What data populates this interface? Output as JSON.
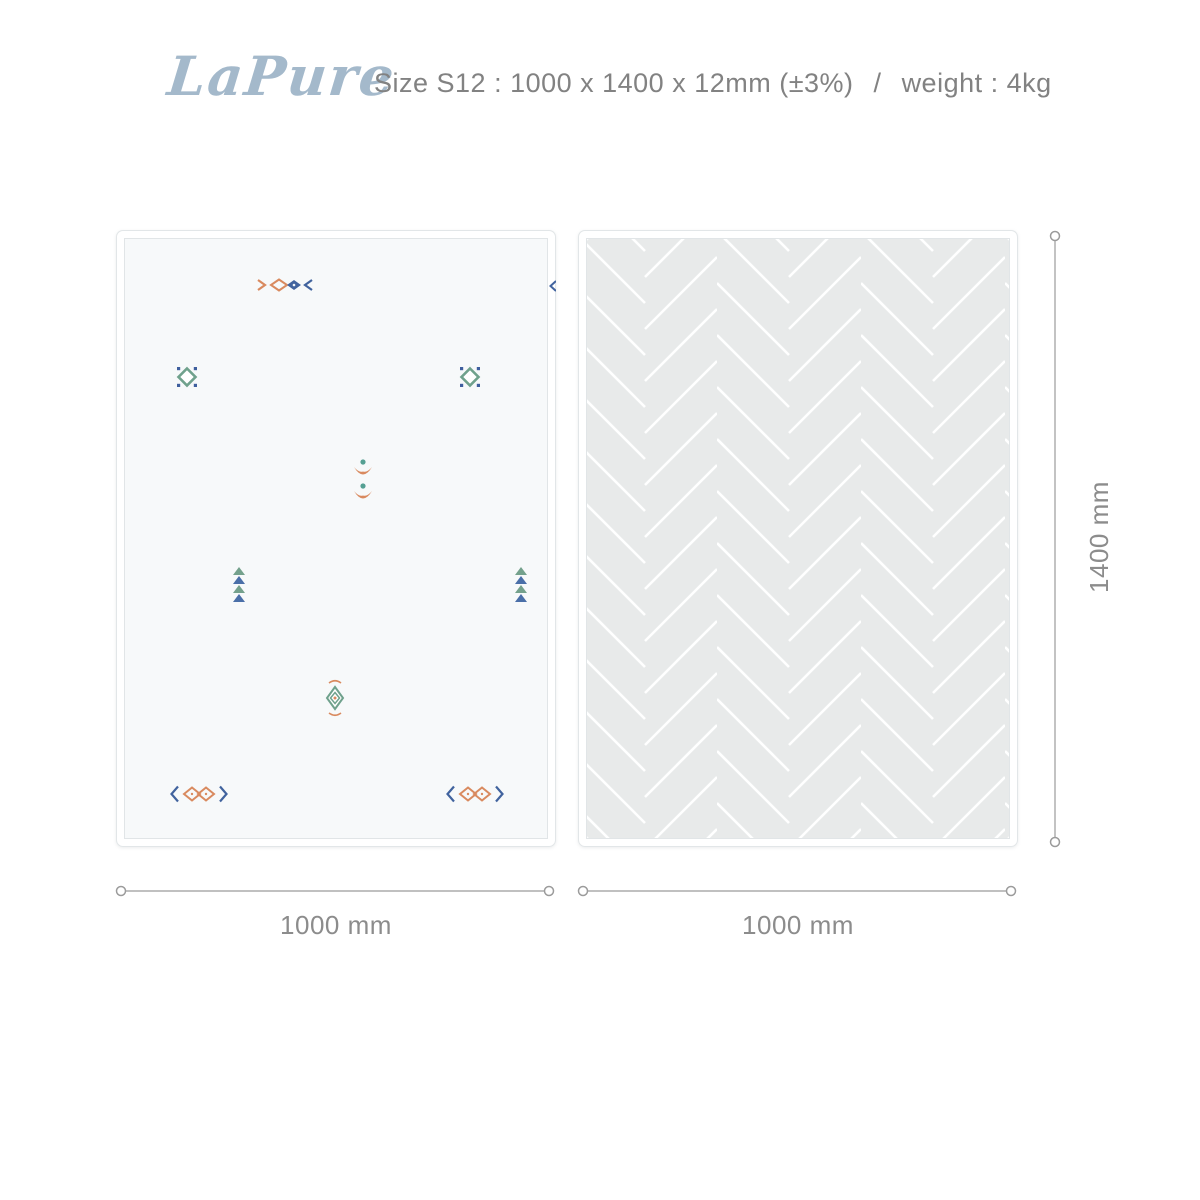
{
  "header": {
    "brand": "LaPure",
    "size_label": "Size S12 : 1000 x 1400 x 12mm (±3%)",
    "separator": "/",
    "weight_label": "weight : 4kg"
  },
  "mats": {
    "left": {
      "description": "mat front side, white with small ethnic motifs",
      "motifs": [
        "fish-diamonds",
        "diamond-with-dots",
        "diamond-with-dots",
        "double-bird-flower",
        "triangle-stack",
        "triangle-stack",
        "concentric-diamond",
        "bracketed-diamonds",
        "bracketed-diamonds"
      ]
    },
    "right": {
      "description": "mat back side, light gray herringbone pattern",
      "pattern": "herringbone"
    }
  },
  "dimensions": {
    "left_width": "1000 mm",
    "right_width": "1000 mm",
    "height": "1400 mm"
  },
  "colors": {
    "brand": "#a4b9cb",
    "spec_text": "#828282",
    "dim_line": "#9b9b9b",
    "dim_text": "#8c8c8c",
    "motif_orange": "#d98a5f",
    "motif_blue": "#41639e",
    "motif_green": "#6fa18c",
    "motif_teal": "#55a093",
    "mat_left_bg": "#f7f9fa",
    "mat_right_bg": "#e8eaea",
    "herringbone_line": "#ffffff"
  }
}
